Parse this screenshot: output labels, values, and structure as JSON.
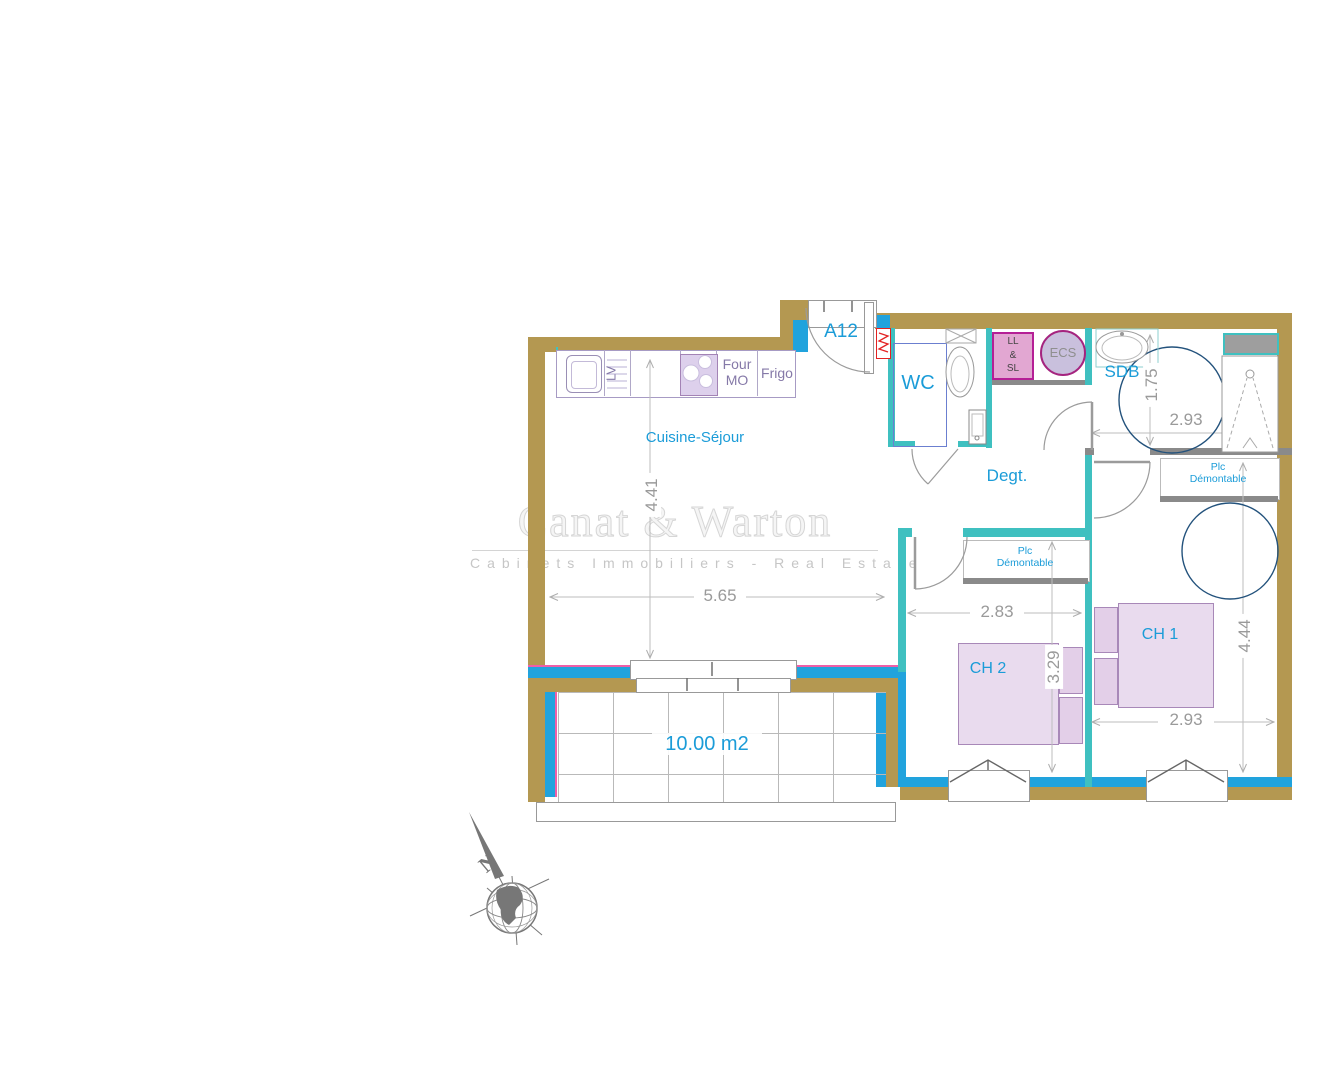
{
  "watermark": {
    "title": "Canat & Warton",
    "subtitle": "Cabinets Immobiliers - Real Estate"
  },
  "plan": {
    "unit": "A12",
    "rooms": {
      "living": "Cuisine-Séjour",
      "wc": "WC",
      "hall": "Degt.",
      "bath": "SDB",
      "bed1": "CH 1",
      "bed2": "CH 2"
    },
    "closet_line1": "Plc",
    "closet_line2": "Démontable",
    "kitchen": {
      "oven": "Four MO",
      "fridge": "Frigo",
      "dishwasher": "LV"
    },
    "utility": {
      "washer_line1": "LL",
      "washer_line2": "&",
      "washer_line3": "SL",
      "water_heater": "ECS"
    },
    "terrace_area": "10.00 m2",
    "compass_north": "N",
    "dims": {
      "living_width": "5.65",
      "living_height": "4.41",
      "bed2_width": "2.83",
      "bed2_height": "3.29",
      "bath_width": "2.93",
      "bath_height": "1.75",
      "bed1_width": "2.93",
      "bed1_height": "4.44"
    }
  },
  "colors": {
    "wall_tan": "#b49851",
    "glazing_blue": "#21a3dd",
    "partition_teal": "#3fc0c0",
    "accent_magenta": "#ef5fa8",
    "label_blue": "#1b9cd8",
    "dimension_gray": "#9a9a9a",
    "furniture_purple": "#a888b8",
    "appliance_pink": "#b51f96",
    "radiator_red": "#e32222",
    "turning_circle_navy": "#23527c"
  }
}
